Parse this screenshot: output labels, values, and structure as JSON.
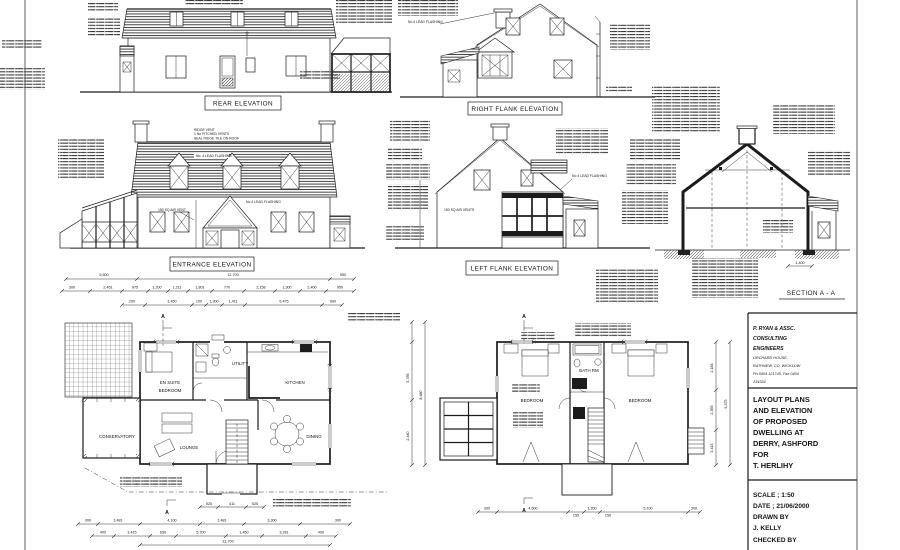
{
  "titles": {
    "rear": "REAR ELEVATION",
    "right_flank": "RIGHT FLANK ELEVATION",
    "entrance": "ENTRANCE ELEVATION",
    "left_flank": "LEFT FLANK ELEVATION",
    "section": "SECTION A - A"
  },
  "annotations": {
    "ridge_vent_1": "RIDGE VENT",
    "ridge_vent_2": "1 No PITCHED VENTS",
    "ridge_vent_3": "SEAL RIDGE TILE ON ROOF",
    "lead_flashing": "No. 4 LEAD FLASHING",
    "lead_flashing_2": "No 4 LEAD FLASHING",
    "air_vent": "150 SQ AIR VENT",
    "air_vents": "150 SQ AIR VENTS",
    "marker_a": "A"
  },
  "rooms": {
    "ground": {
      "ensuite_1": "EN SUITE",
      "ensuite_2": "BEDROOM",
      "utility": "UTILITY",
      "kitchen": "KITCHEN",
      "conservatory": "CONSERVATORY",
      "lounge": "LOUNGE",
      "dining": "DINING"
    },
    "first": {
      "bedroom_left": "BEDROOM",
      "bath": "BATH RM",
      "bedroom_right": "BEDROOM"
    }
  },
  "dims": {
    "entrance_row1": [
      "5,600",
      "12,700",
      "950"
    ],
    "entrance_row2": [
      "300",
      "2,451",
      "975",
      "1,200",
      "1,211",
      "1,801",
      "770",
      "2,158",
      "1,300",
      "2,400",
      "950"
    ],
    "entrance_row3": [
      "200",
      "3,450",
      "100",
      "1,300",
      "1,411",
      "5,475",
      "800"
    ],
    "gf_bottom_row1": [
      "300",
      "3,481",
      "4,100",
      "2,481",
      "3,300",
      "300"
    ],
    "gf_bottom_row2": [
      "400",
      "3,415",
      "650",
      "5,700",
      "1,450",
      "3,281",
      "400"
    ],
    "gf_total": "12,700",
    "gf_porch": [
      "525",
      "411",
      "525"
    ],
    "gf_right": [
      "5,785",
      "2,440"
    ],
    "gf_right_total": "8,480",
    "ff_bottom": [
      "300",
      "4,600",
      "150",
      "1,200",
      "150",
      "5,100",
      "300"
    ],
    "ff_right": [
      "2,184",
      "2,365",
      "3,415"
    ],
    "ff_right_total": "9,375",
    "section_dim": "1,400"
  },
  "title_block": {
    "firm_line1": "P. RYAN & ASSC.",
    "firm_line2": "CONSULTING",
    "firm_line3": "ENGINEERS",
    "address_line1": "ORCHARD HOUSE,",
    "address_line2": "RATHNEW, CO. WICKLOW",
    "address_line3": "Ph.0404 121745, Fax 0404",
    "address_line4": "234324",
    "project_lines": [
      "LAYOUT PLANS",
      "AND ELEVATION",
      "OF PROPOSED",
      "DWELLING AT",
      "DERRY, ASHFORD",
      "FOR",
      "T. HERLIHY"
    ],
    "scale": "SCALE ; 1:50",
    "date": "DATE ; 21/06/2000",
    "drawn_by_label": "DRAWN BY",
    "drawn_by": "J. KELLY",
    "checked_by_label": "CHECKED BY"
  }
}
